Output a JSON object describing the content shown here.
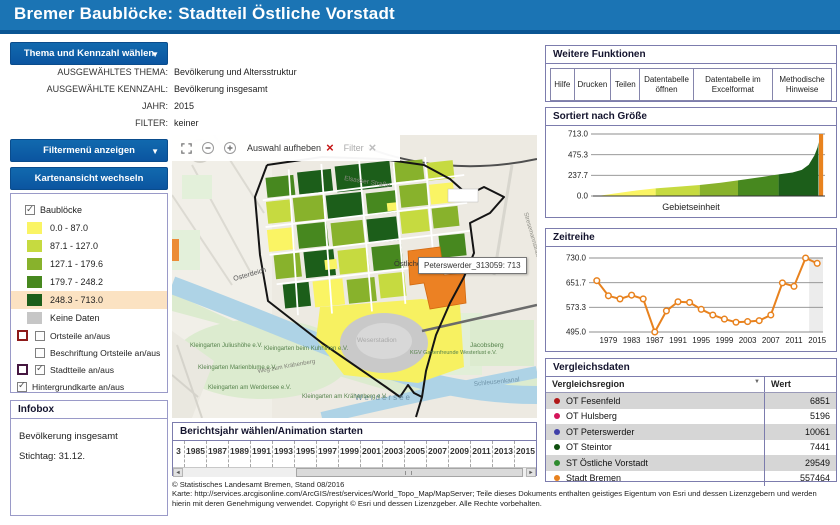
{
  "header": {
    "title": "Bremer Baublöcke: Stadtteil Östliche Vorstadt"
  },
  "controls": {
    "theme_button": "Thema und Kennzahl wählen",
    "filter_button": "Filtermenü anzeigen",
    "map_button": "Kartenansicht wechseln",
    "selected": {
      "theme_label": "AUSGEWÄHLTES THEMA:",
      "theme_value": "Bevölkerung und Altersstruktur",
      "kennzahl_label": "AUSGEWÄHLTE KENNZAHL:",
      "kennzahl_value": "Bevölkerung insgesamt",
      "jahr_label": "JAHR:",
      "jahr_value": "2015",
      "filter_label": "FILTER:",
      "filter_value": "keiner"
    }
  },
  "legend": {
    "title": "Baublöcke",
    "classes": [
      {
        "range": "0.0 - 87.0",
        "color": "#FAF464",
        "highlighted": false
      },
      {
        "range": "87.1 - 127.0",
        "color": "#C6DA40",
        "highlighted": false
      },
      {
        "range": "127.1 - 179.6",
        "color": "#88B22C",
        "highlighted": false
      },
      {
        "range": "179.7 - 248.2",
        "color": "#47881F",
        "highlighted": false
      },
      {
        "range": "248.3 - 713.0",
        "color": "#1C5E1A",
        "highlighted": true
      }
    ],
    "no_data_label": "Keine Daten",
    "no_data_color": "#C6C6C6",
    "toggles": [
      {
        "label": "Ortsteile an/aus",
        "checked": false,
        "outline": "#8E1A1A",
        "indent": true
      },
      {
        "label": "Beschriftung Ortsteile an/aus",
        "checked": false,
        "outline": null,
        "indent": true
      },
      {
        "label": "Stadtteile an/aus",
        "checked": true,
        "outline": "#451740",
        "indent": true
      },
      {
        "label": "Hintergrundkarte an/aus",
        "checked": true,
        "outline": null,
        "indent": false
      }
    ]
  },
  "infobox": {
    "title": "Infobox",
    "lines": [
      "Bevölkerung insgesamt",
      "Stichtag: 31.12."
    ]
  },
  "map": {
    "toolbar": {
      "clear_label": "Auswahl aufheben",
      "filter_label": "Filter"
    },
    "tooltip": "Peterswerder_313059: 713",
    "labels": [
      "Osterdeich",
      "Östliche Vorstadt",
      "Werdersee",
      "Weserstadion",
      "Kleingarten Juliushöhe e.V.",
      "Kleingarten Marienblume e.V.",
      "Kleingarten am Werdersee e.V.",
      "Kleingarten beim Kuhhirten e.V.",
      "Weg zum Krähenberg",
      "Kleingarten am Krähenberg e.V.",
      "KGV Gartenfreunde Westerlust e.V.",
      "Jacobsberg",
      "Schleusenkanal",
      "Elsasser Straße",
      "Stresemannstraße"
    ]
  },
  "timeline": {
    "title": "Berichtsjahr wählen/Animation starten",
    "years": [
      "3",
      "1985",
      "1987",
      "1989",
      "1991",
      "1993",
      "1995",
      "1997",
      "1999",
      "2001",
      "2003",
      "2005",
      "2007",
      "2009",
      "2011",
      "2013",
      "2015"
    ]
  },
  "footer": {
    "line1": "© Statistisches Landesamt Bremen, Stand 08/2016",
    "line2": "Karte: http://services.arcgisonline.com/ArcGIS/rest/services/World_Topo_Map/MapServer; Teile dieses Dokuments enthalten geistiges Eigentum von Esri und dessen Lizenzgebern und werden hierin mit deren Genehmigung verwendet. Copyright © Esri und dessen Lizenzgeber. Alle Rechte vorbehalten."
  },
  "functions_panel": {
    "title": "Weitere Funktionen",
    "buttons": [
      "Hilfe",
      "Drucken",
      "Teilen",
      "Datentabelle öffnen",
      "Datentabelle im Excelformat",
      "Methodische Hinweise"
    ]
  },
  "comparison": {
    "title": "Vergleichsdaten",
    "col_region": "Vergleichsregion",
    "col_value": "Wert",
    "rows": [
      {
        "dot": "#B01717",
        "region": "OT Fesenfeld",
        "value": "6851"
      },
      {
        "dot": "#D4145A",
        "region": "OT Hulsberg",
        "value": "5196"
      },
      {
        "dot": "#4040A8",
        "region": "OT Peterswerder",
        "value": "10061"
      },
      {
        "dot": "#0F4F0F",
        "region": "OT Steintor",
        "value": "7441"
      },
      {
        "dot": "#2E8B2E",
        "region": "ST Östliche Vorstadt",
        "value": "29549"
      },
      {
        "dot": "#E8821E",
        "region": "Stadt Bremen",
        "value": "557464"
      }
    ]
  },
  "chart_data": [
    {
      "type": "area",
      "title": "Sortiert nach Größe",
      "xlabel": "Gebietseinheit",
      "ylim": [
        0,
        713
      ],
      "yticks": [
        "713.0",
        "475.3",
        "237.7",
        "0.0"
      ],
      "selected_color": "#E8821E",
      "selected_value": 713,
      "segments": [
        {
          "color": "#FAF464",
          "pts": [
            [
              0.03,
              4
            ],
            [
              0.09,
              28
            ],
            [
              0.17,
              58
            ],
            [
              0.27,
              87
            ]
          ]
        },
        {
          "color": "#C6DA40",
          "pts": [
            [
              0.27,
              87
            ],
            [
              0.37,
              108
            ],
            [
              0.46,
              127
            ]
          ]
        },
        {
          "color": "#88B22C",
          "pts": [
            [
              0.46,
              127
            ],
            [
              0.55,
              152
            ],
            [
              0.625,
              179.6
            ]
          ]
        },
        {
          "color": "#47881F",
          "pts": [
            [
              0.625,
              179.6
            ],
            [
              0.72,
              215
            ],
            [
              0.8,
              248.2
            ]
          ]
        },
        {
          "color": "#1C5E1A",
          "pts": [
            [
              0.8,
              248.2
            ],
            [
              0.86,
              270
            ],
            [
              0.9,
              300
            ],
            [
              0.93,
              360
            ],
            [
              0.955,
              470
            ],
            [
              0.968,
              560
            ],
            [
              0.972,
              620
            ]
          ]
        },
        {
          "color": "#E8821E",
          "pts": [
            [
              0.974,
              713
            ],
            [
              0.992,
              713
            ]
          ]
        }
      ]
    },
    {
      "type": "line",
      "title": "Zeitreihe",
      "x": [
        1977,
        1979,
        1981,
        1983,
        1985,
        1987,
        1989,
        1991,
        1993,
        1995,
        1997,
        1999,
        2001,
        2003,
        2005,
        2007,
        2009,
        2011,
        2013,
        2015
      ],
      "values": [
        658,
        610,
        600,
        612,
        600,
        495,
        562,
        591,
        589,
        567,
        549,
        536,
        526,
        528,
        531,
        549,
        651,
        640,
        730,
        713
      ],
      "yticks": [
        "730.0",
        "651.7",
        "573.3",
        "495.0"
      ],
      "ylim": [
        495,
        730
      ],
      "xticks": [
        1979,
        1983,
        1987,
        1991,
        1995,
        1999,
        2003,
        2007,
        2011,
        2015
      ],
      "xlim": [
        1976,
        2016
      ],
      "line_color": "#E8821E",
      "highlight_band": [
        2013.6,
        2016
      ]
    }
  ]
}
